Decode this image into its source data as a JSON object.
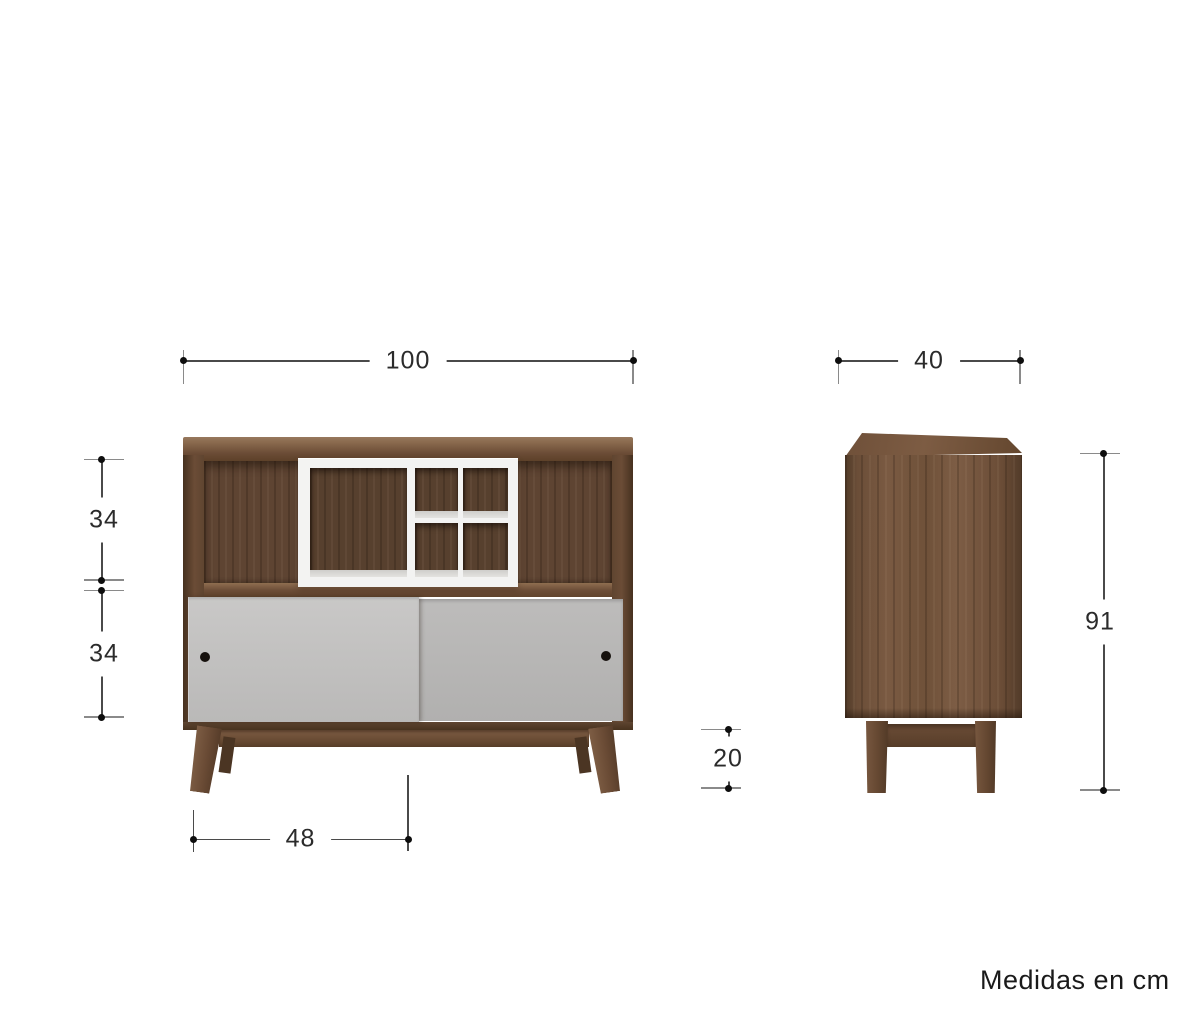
{
  "note": "Medidas en cm",
  "dimensions": {
    "front_width": "100",
    "side_depth": "40",
    "front_upper_height": "34",
    "front_lower_height": "34",
    "leg_span": "48",
    "leg_height": "20",
    "side_height": "91"
  },
  "colors": {
    "background": "#ffffff",
    "wood_light": "#8a6a4e",
    "wood_mid": "#6b4c36",
    "wood_interior": "#5e4432",
    "door_gray_front": "#c9c8c7",
    "door_gray_back": "#bdbcbb",
    "insert_white": "#f3f3f2",
    "handle_black": "#16110d",
    "dim_line": "#4a4a4a",
    "dim_tick": "#8a8a8a",
    "dim_dot": "#0e0e0e",
    "dim_text": "#2b2b2b"
  }
}
